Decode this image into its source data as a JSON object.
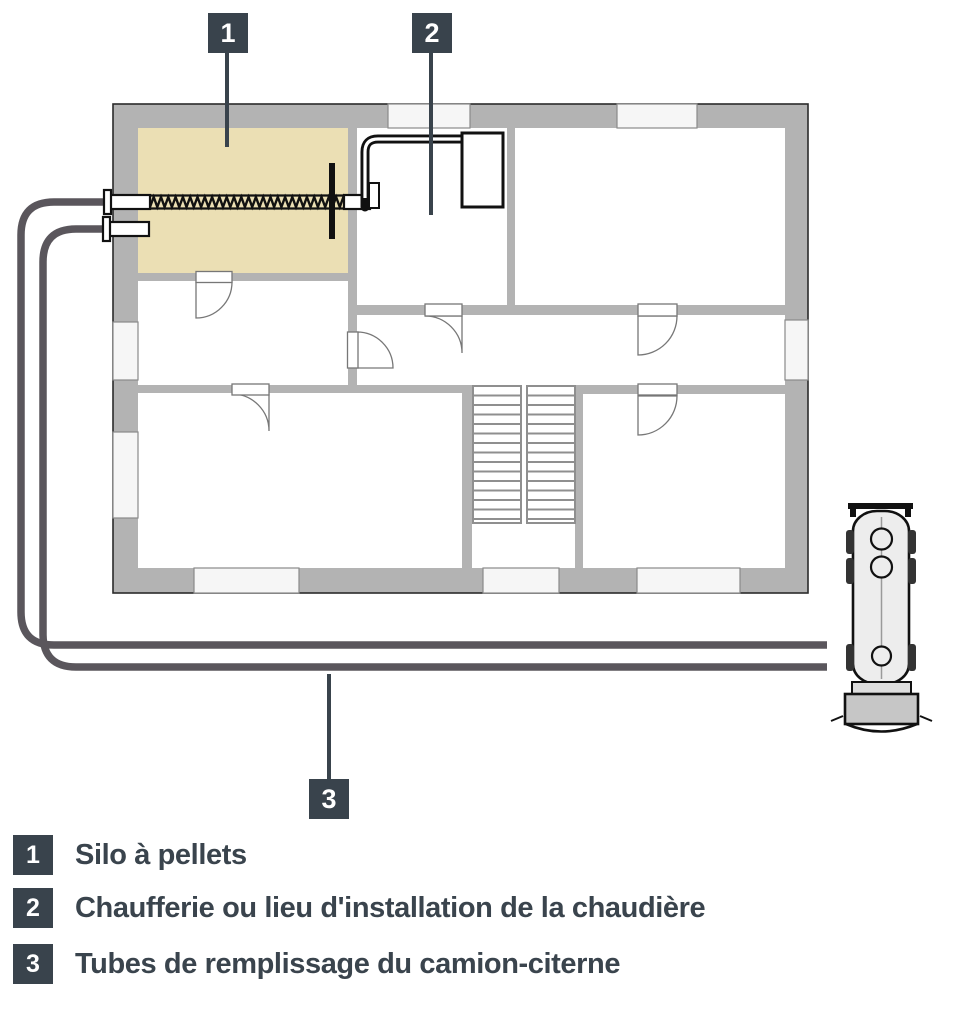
{
  "callouts": [
    {
      "number": "1"
    },
    {
      "number": "2"
    },
    {
      "number": "3"
    }
  ],
  "legend": {
    "items": [
      {
        "number": "1",
        "label": "Silo à pellets"
      },
      {
        "number": "2",
        "label": "Chaufferie ou lieu d'installation de la chaudière"
      },
      {
        "number": "3",
        "label": "Tubes de remplissage du camion-citerne"
      }
    ]
  },
  "colors": {
    "badge_bg": "#39434c",
    "legend_text": "#3a444d",
    "wall_gray": "#b3b3b3",
    "silo_room_fill": "#ebdfb4",
    "filling_tube": "#5a565c",
    "window_fill": "#f6f6f6",
    "truck_tank_fill": "#ededed"
  }
}
